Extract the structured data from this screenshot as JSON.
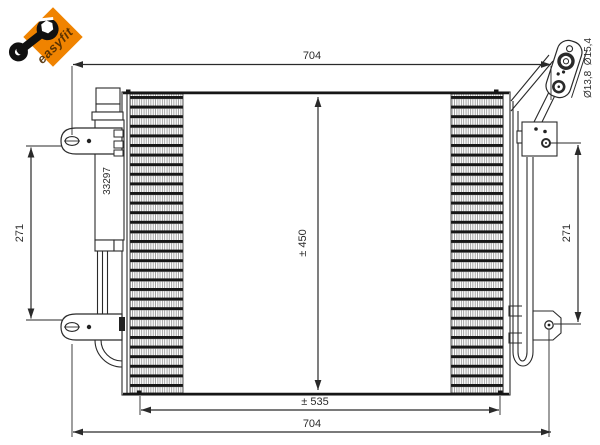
{
  "logo": {
    "text": "easyfit",
    "bg_color": "#F08300",
    "text_color": "#4D2B00"
  },
  "part": {
    "number": "33297"
  },
  "dimensions": {
    "overall_width_top": "704",
    "overall_width_bottom": "704",
    "core_width": "± 535",
    "core_height": "± 450",
    "bracket_pitch_left": "271",
    "bracket_pitch_right": "271",
    "connector_diameters": "Ø13,8  Ø15,4"
  },
  "colors": {
    "line": "#2A2A2A",
    "dark_edge": "#161616",
    "accent_orange": "#F08300"
  }
}
